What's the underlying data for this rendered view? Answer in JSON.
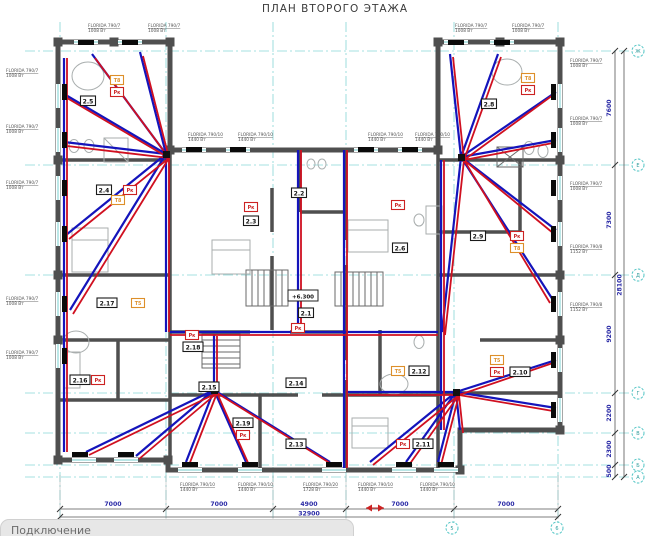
{
  "title": "ПЛАН ВТОРОГО ЭТАЖА",
  "footer": {
    "label": "Подключение"
  },
  "level_mark": {
    "text": "+6.300",
    "x": 303,
    "y": 296
  },
  "colors": {
    "supply_pipe": "#d01020",
    "return_pipe": "#1414bb",
    "grid": "#86d6d6",
    "wall": "#4f4f4f",
    "dimension_text": "#2a2aa6",
    "tag_red": "#cc2222",
    "tag_orange": "#dd8f2a"
  },
  "dimensions": {
    "bottom": {
      "segments": [
        {
          "text": "7000",
          "x": 113
        },
        {
          "text": "7000",
          "x": 219
        },
        {
          "text": "4900",
          "x": 309
        },
        {
          "text": "7000",
          "x": 400
        },
        {
          "text": "7000",
          "x": 506
        }
      ],
      "label_y": 506,
      "ticks": [
        60,
        166,
        273,
        346,
        454,
        558
      ],
      "total": {
        "text": "32900",
        "x": 309,
        "y": 515.5
      }
    },
    "right": {
      "segments": [
        {
          "text": "7600",
          "y": 108
        },
        {
          "text": "7300",
          "y": 220
        },
        {
          "text": "9200",
          "y": 334
        },
        {
          "text": "2200",
          "y": 413
        },
        {
          "text": "2300",
          "y": 449
        },
        {
          "text": "500",
          "y": 471
        }
      ],
      "label_x": 611,
      "ticks": [
        51,
        165,
        275,
        393,
        433,
        465,
        477
      ],
      "total": {
        "text": "28100",
        "x": 621.5,
        "y": 285
      }
    }
  },
  "axis_bubbles": {
    "right": [
      {
        "label": "Ж",
        "y": 51
      },
      {
        "label": "Е",
        "y": 165
      },
      {
        "label": "Д",
        "y": 275
      },
      {
        "label": "Г",
        "y": 393
      },
      {
        "label": "В",
        "y": 433
      },
      {
        "label": "Б",
        "y": 465
      },
      {
        "label": "А",
        "y": 477
      }
    ],
    "bottom": [
      {
        "label": "5",
        "x": 452
      },
      {
        "label": "6",
        "x": 557
      }
    ],
    "x_right": 638,
    "y_bottom": 528
  },
  "rooms": [
    {
      "id": "2.5",
      "x": 88,
      "y": 101
    },
    {
      "id": "2.4",
      "x": 104,
      "y": 190
    },
    {
      "id": "2.3",
      "x": 251,
      "y": 221
    },
    {
      "id": "2.2",
      "x": 299,
      "y": 193
    },
    {
      "id": "2.1",
      "x": 306,
      "y": 313
    },
    {
      "id": "2.6",
      "x": 400,
      "y": 248
    },
    {
      "id": "2.8",
      "x": 489,
      "y": 104
    },
    {
      "id": "2.9",
      "x": 478,
      "y": 236
    },
    {
      "id": "2.10",
      "x": 520,
      "y": 372
    },
    {
      "id": "2.12",
      "x": 419,
      "y": 371
    },
    {
      "id": "2.11",
      "x": 423,
      "y": 444
    },
    {
      "id": "2.13",
      "x": 296,
      "y": 444
    },
    {
      "id": "2.14",
      "x": 296,
      "y": 383
    },
    {
      "id": "2.15",
      "x": 209,
      "y": 387
    },
    {
      "id": "2.18",
      "x": 193,
      "y": 347
    },
    {
      "id": "2.19",
      "x": 243,
      "y": 423
    },
    {
      "id": "2.17",
      "x": 107,
      "y": 303
    },
    {
      "id": "2.16",
      "x": 80,
      "y": 380
    }
  ],
  "tags": [
    {
      "text": "Т8",
      "color": "orange",
      "x": 117,
      "y": 80
    },
    {
      "text": "Т8",
      "color": "orange",
      "x": 118,
      "y": 200
    },
    {
      "text": "Т8",
      "color": "orange",
      "x": 517,
      "y": 248
    },
    {
      "text": "Т8",
      "color": "orange",
      "x": 528,
      "y": 78
    },
    {
      "text": "Т5",
      "color": "orange",
      "x": 138,
      "y": 303
    },
    {
      "text": "Т5",
      "color": "orange",
      "x": 398,
      "y": 371
    },
    {
      "text": "Т5",
      "color": "orange",
      "x": 497,
      "y": 360
    },
    {
      "text": "Рк",
      "color": "red",
      "x": 117,
      "y": 92
    },
    {
      "text": "Рк",
      "color": "red",
      "x": 130,
      "y": 190
    },
    {
      "text": "Рк",
      "color": "red",
      "x": 251,
      "y": 207
    },
    {
      "text": "Рк",
      "color": "red",
      "x": 398,
      "y": 205
    },
    {
      "text": "Рк",
      "color": "red",
      "x": 517,
      "y": 236
    },
    {
      "text": "Рк",
      "color": "red",
      "x": 528,
      "y": 90
    },
    {
      "text": "Рк",
      "color": "red",
      "x": 497,
      "y": 372
    },
    {
      "text": "Рк",
      "color": "red",
      "x": 403,
      "y": 444
    },
    {
      "text": "Рк",
      "color": "red",
      "x": 243,
      "y": 435
    },
    {
      "text": "Рк",
      "color": "red",
      "x": 192,
      "y": 335
    },
    {
      "text": "Рк",
      "color": "red",
      "x": 98,
      "y": 380
    },
    {
      "text": "Рк",
      "color": "red",
      "x": 298,
      "y": 328
    }
  ],
  "radiator_labels": [
    {
      "name": "FLORIDA 790/7",
      "power": "1008 Вт",
      "x": 88,
      "y": 27
    },
    {
      "name": "FLORIDA 790/7",
      "power": "1008 Вт",
      "x": 148,
      "y": 27
    },
    {
      "name": "FLORIDA 790/7",
      "power": "1008 Вт",
      "x": 455,
      "y": 27
    },
    {
      "name": "FLORIDA 790/7",
      "power": "1008 Вт",
      "x": 512,
      "y": 27
    },
    {
      "name": "FLORIDA 790/10",
      "power": "1440 Вт",
      "x": 188,
      "y": 136
    },
    {
      "name": "FLORIDA 790/10",
      "power": "1440 Вт",
      "x": 238,
      "y": 136
    },
    {
      "name": "FLORIDA 790/10",
      "power": "1440 Вт",
      "x": 368,
      "y": 136
    },
    {
      "name": "FLORIDA 790/10",
      "power": "1440 Вт",
      "x": 415,
      "y": 136
    },
    {
      "name": "FLORIDA 790/7",
      "power": "1008 Вт",
      "x": 6,
      "y": 72
    },
    {
      "name": "FLORIDA 790/7",
      "power": "1008 Вт",
      "x": 6,
      "y": 128
    },
    {
      "name": "FLORIDA 790/7",
      "power": "1008 Вт",
      "x": 6,
      "y": 184
    },
    {
      "name": "FLORIDA 790/7",
      "power": "1008 Вт",
      "x": 6,
      "y": 300
    },
    {
      "name": "FLORIDA 790/7",
      "power": "1008 Вт",
      "x": 6,
      "y": 354
    },
    {
      "name": "FLORIDA 790/7",
      "power": "1008 Вт",
      "x": 570,
      "y": 62
    },
    {
      "name": "FLORIDA 790/7",
      "power": "1008 Вт",
      "x": 570,
      "y": 120
    },
    {
      "name": "FLORIDA 790/7",
      "power": "1008 Вт",
      "x": 570,
      "y": 185
    },
    {
      "name": "FLORIDA 790/8",
      "power": "1152 Вт",
      "x": 570,
      "y": 248
    },
    {
      "name": "FLORIDA 790/8",
      "power": "1152 Вт",
      "x": 570,
      "y": 306
    },
    {
      "name": "FLORIDA 790/10",
      "power": "1440 Вт",
      "x": 180,
      "y": 486
    },
    {
      "name": "FLORIDA 790/10",
      "power": "1440 Вт",
      "x": 238,
      "y": 486
    },
    {
      "name": "FLORIDA 790/20",
      "power": "1728 Вт",
      "x": 303,
      "y": 486
    },
    {
      "name": "FLORIDA 790/10",
      "power": "1440 Вт",
      "x": 358,
      "y": 486
    },
    {
      "name": "FLORIDA 790/10",
      "power": "1440 Вт",
      "x": 420,
      "y": 486
    }
  ]
}
